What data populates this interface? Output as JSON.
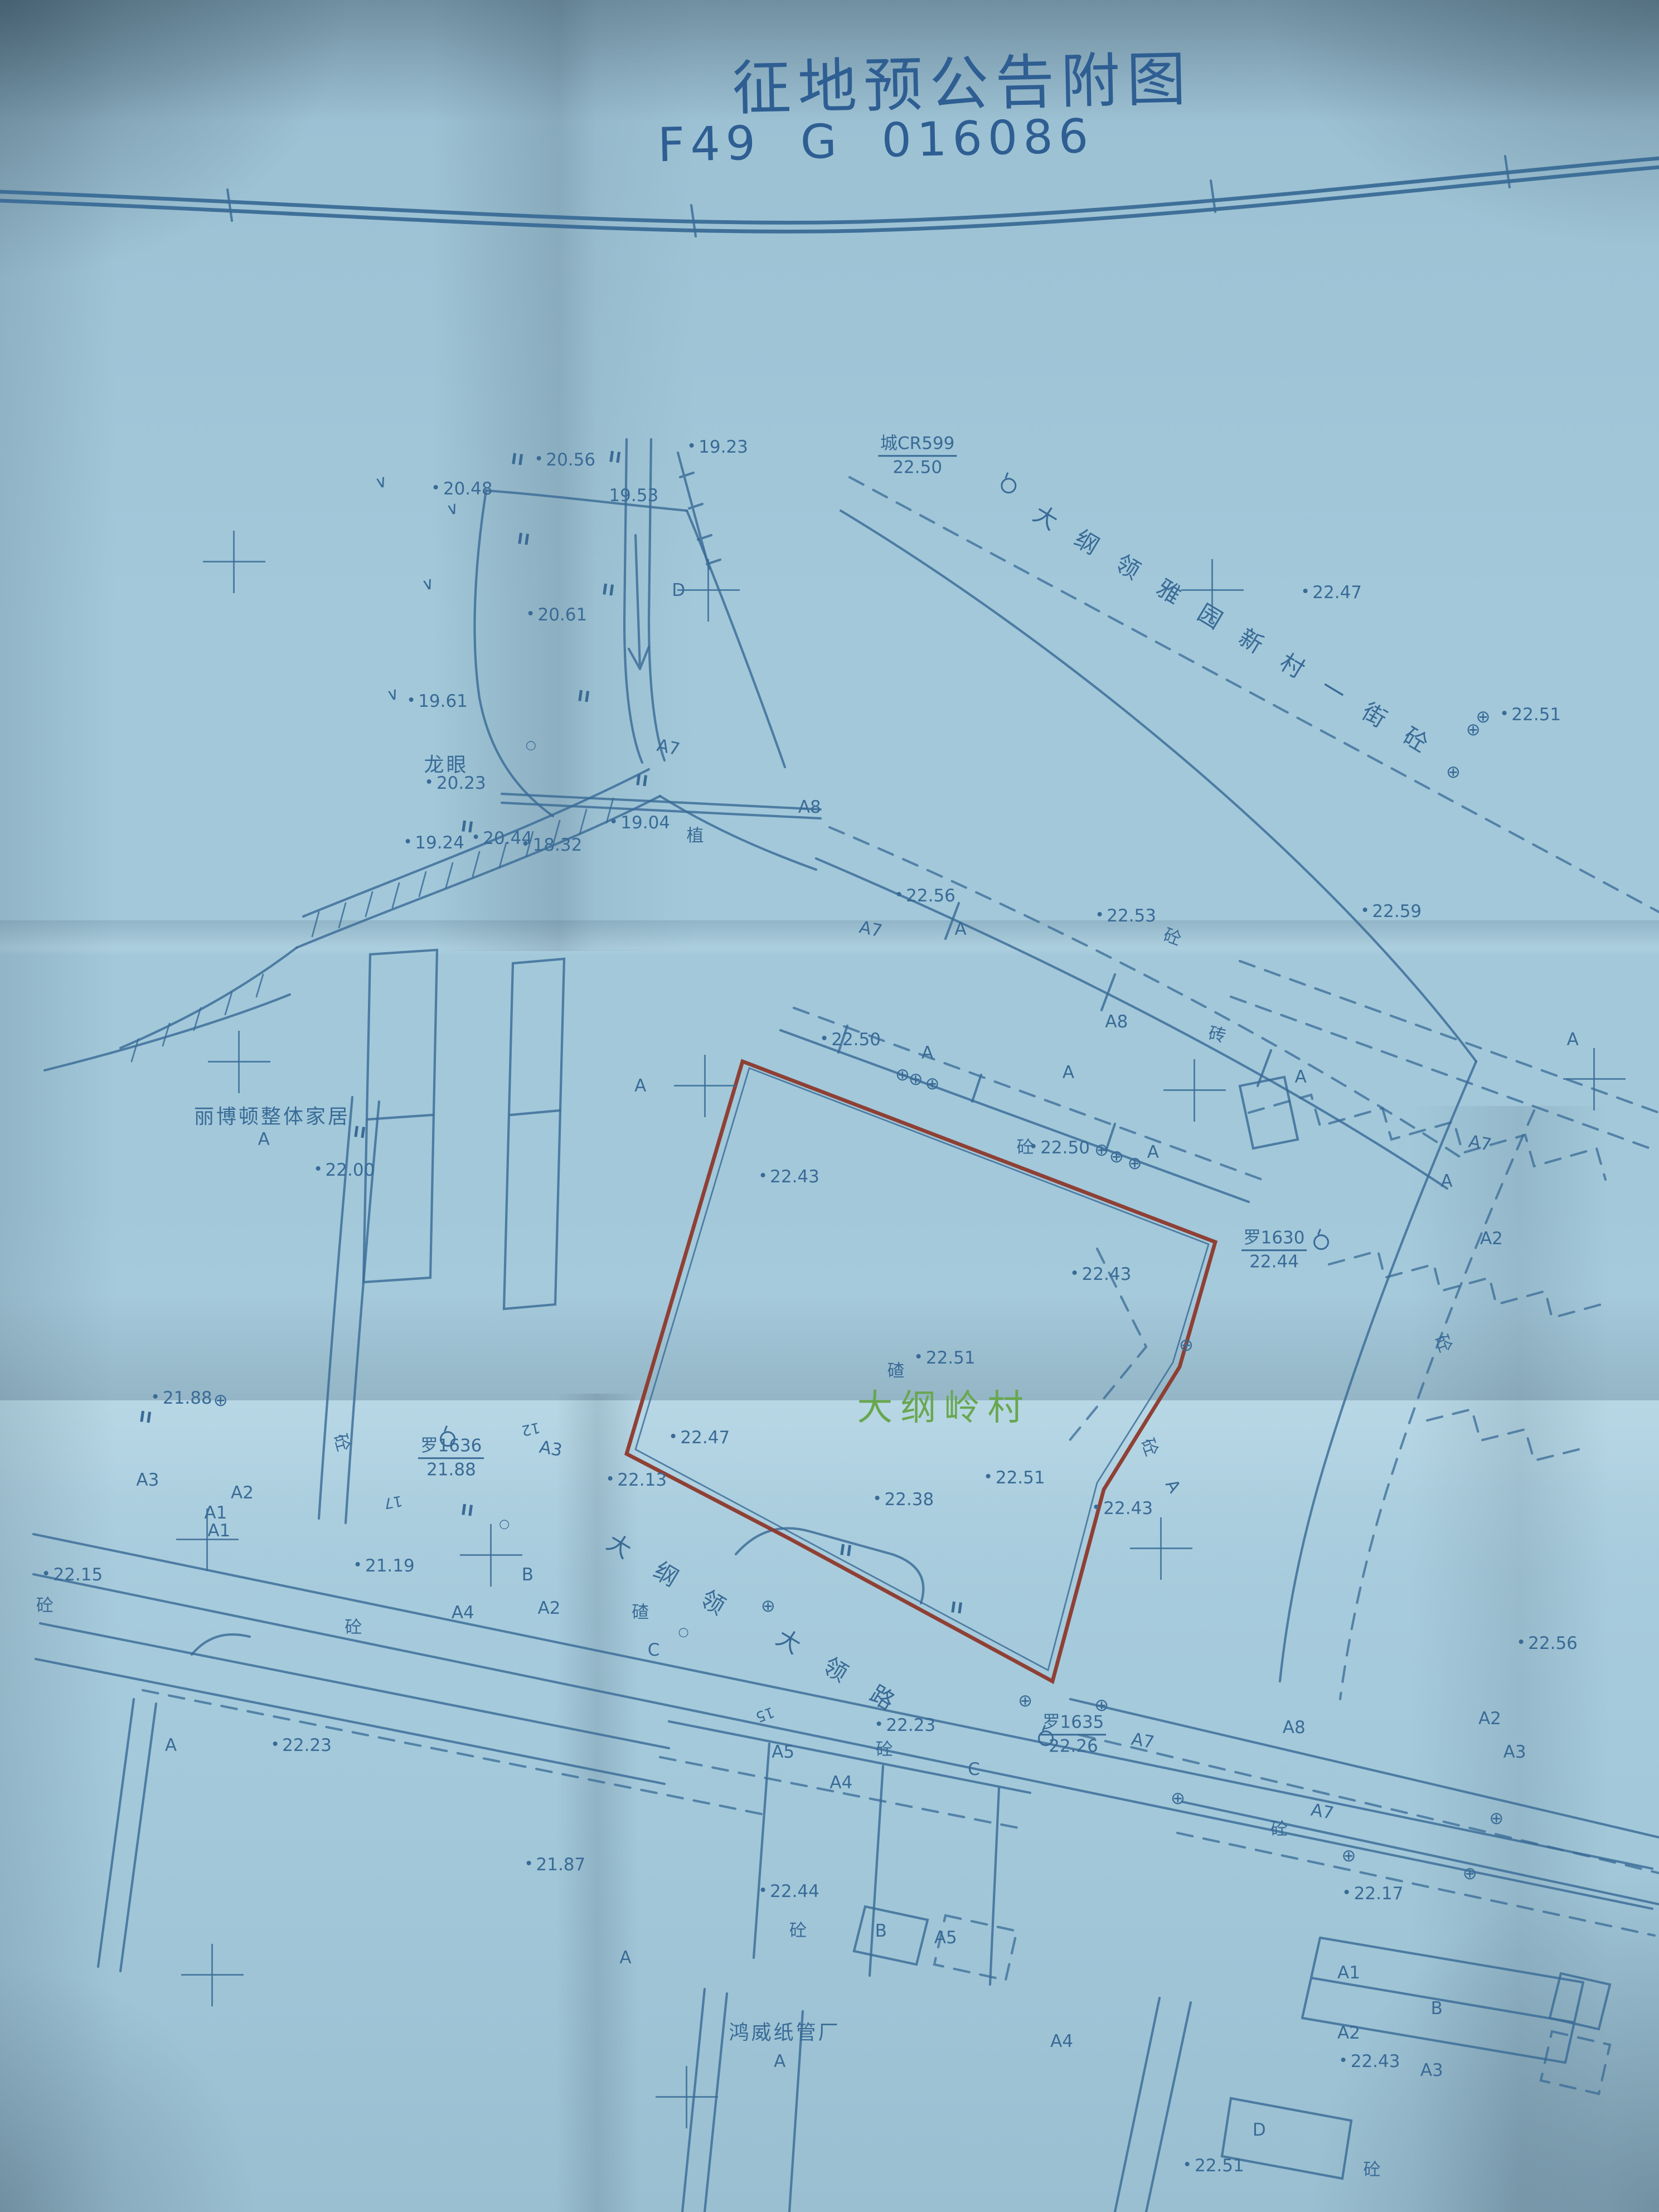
{
  "title": {
    "line1": "征地预公告附图",
    "line2": "F49 G 016086"
  },
  "colors": {
    "paper": "#a2c8da",
    "ink": "#3a6b96",
    "red_boundary": "#8e3a2e",
    "village_green": "#69a750",
    "title_blue": "#2e5e92"
  },
  "roads": {
    "road1": {
      "name": "大纲领雅园新村一街砼"
    },
    "road2_part1": "大纲领",
    "road2_part2": "大领路"
  },
  "icons": {
    "lamp": "⊕",
    "circle": "○",
    "veg": "∨",
    "paddy": "II"
  },
  "control_points": [
    {
      "name": "城CR599",
      "elev": "22.50",
      "x": 55.3,
      "y": 20.6,
      "sx": 150,
      "sy": 40
    },
    {
      "name": "罗1630",
      "elev": "22.44",
      "x": 76.8,
      "y": 56.5,
      "sx": 70,
      "sy": -28
    },
    {
      "name": "罗1636",
      "elev": "21.88",
      "x": 27.2,
      "y": 65.9,
      "sx": -20,
      "sy": -48
    },
    {
      "name": "罗1635",
      "elev": "22.26",
      "x": 64.7,
      "y": 78.4,
      "sx": -63,
      "sy": -7
    }
  ],
  "labels": [
    {
      "t": "20.56",
      "x": 34.4,
      "y": 20.8,
      "c": "elev"
    },
    {
      "t": "19.23",
      "x": 43.6,
      "y": 20.2,
      "c": "elev"
    },
    {
      "t": "20.48",
      "x": 28.2,
      "y": 22.1,
      "c": "elev"
    },
    {
      "t": "19.53",
      "x": 38.2,
      "y": 22.4,
      "c": "plain"
    },
    {
      "t": "20.61",
      "x": 33.9,
      "y": 27.8,
      "c": "elev"
    },
    {
      "t": "D",
      "x": 40.9,
      "y": 26.7,
      "c": "bld"
    },
    {
      "t": "19.61",
      "x": 26.7,
      "y": 31.7,
      "c": "elev"
    },
    {
      "t": "龙眼",
      "x": 26.9,
      "y": 34.5,
      "c": "name"
    },
    {
      "t": "20.23",
      "x": 27.8,
      "y": 35.4,
      "c": "elev"
    },
    {
      "t": "A7",
      "x": 40.3,
      "y": 33.8,
      "c": "bld",
      "r": 12
    },
    {
      "t": "19.24",
      "x": 26.5,
      "y": 38.1,
      "c": "elev"
    },
    {
      "t": "20.44",
      "x": 30.6,
      "y": 37.9,
      "c": "elev"
    },
    {
      "t": "18.32",
      "x": 33.6,
      "y": 38.2,
      "c": "elev"
    },
    {
      "t": "19.04",
      "x": 38.9,
      "y": 37.2,
      "c": "elev"
    },
    {
      "t": "植",
      "x": 41.9,
      "y": 37.7,
      "c": "mat"
    },
    {
      "t": "A8",
      "x": 48.8,
      "y": 36.5,
      "c": "bld"
    },
    {
      "t": "22.47",
      "x": 80.6,
      "y": 26.8,
      "c": "elev"
    },
    {
      "t": "22.51",
      "x": 92.6,
      "y": 32.3,
      "c": "elev"
    },
    {
      "t": "A7",
      "x": 52.5,
      "y": 42.0,
      "c": "bld",
      "r": 12
    },
    {
      "t": "22.56",
      "x": 56.1,
      "y": 40.5,
      "c": "elev"
    },
    {
      "t": "A",
      "x": 57.9,
      "y": 42.0,
      "c": "bld"
    },
    {
      "t": "22.53",
      "x": 68.2,
      "y": 41.4,
      "c": "elev"
    },
    {
      "t": "砼",
      "x": 70.7,
      "y": 42.3,
      "c": "mat",
      "r": 20
    },
    {
      "t": "22.59",
      "x": 84.2,
      "y": 41.2,
      "c": "elev"
    },
    {
      "t": "A8",
      "x": 67.3,
      "y": 46.2,
      "c": "bld"
    },
    {
      "t": "砖",
      "x": 73.4,
      "y": 46.7,
      "c": "mat",
      "r": 12
    },
    {
      "t": "A",
      "x": 78.4,
      "y": 48.7,
      "c": "bld"
    },
    {
      "t": "A",
      "x": 94.8,
      "y": 47.0,
      "c": "bld"
    },
    {
      "t": "A7",
      "x": 89.2,
      "y": 51.7,
      "c": "bld",
      "r": 10
    },
    {
      "t": "A",
      "x": 87.2,
      "y": 53.4,
      "c": "bld"
    },
    {
      "t": "22.50",
      "x": 51.6,
      "y": 47.0,
      "c": "elev"
    },
    {
      "t": "A",
      "x": 55.9,
      "y": 47.6,
      "c": "bld"
    },
    {
      "t": "A",
      "x": 64.4,
      "y": 48.5,
      "c": "bld"
    },
    {
      "t": "A",
      "x": 69.5,
      "y": 52.1,
      "c": "bld"
    },
    {
      "t": "A",
      "x": 38.6,
      "y": 49.1,
      "c": "bld"
    },
    {
      "t": "22.43",
      "x": 47.9,
      "y": 53.2,
      "c": "elev"
    },
    {
      "t": "砼",
      "x": 61.8,
      "y": 51.8,
      "c": "mat"
    },
    {
      "t": "22.50",
      "x": 64.2,
      "y": 51.9,
      "c": "elev"
    },
    {
      "t": "22.43",
      "x": 66.7,
      "y": 57.6,
      "c": "elev"
    },
    {
      "t": "A2",
      "x": 89.9,
      "y": 56.0,
      "c": "bld"
    },
    {
      "t": "砼",
      "x": 87.1,
      "y": 60.7,
      "c": "mat",
      "r": 70
    },
    {
      "t": "碴",
      "x": 54.0,
      "y": 61.9,
      "c": "mat"
    },
    {
      "t": "22.51",
      "x": 57.3,
      "y": 61.4,
      "c": "elev"
    },
    {
      "t": "大纲岭村",
      "x": 56.9,
      "y": 63.5,
      "c": "village"
    },
    {
      "t": "22.00",
      "x": 21.1,
      "y": 52.9,
      "c": "elev"
    },
    {
      "t": "丽博顿整体家居",
      "x": 16.4,
      "y": 50.4,
      "c": "name"
    },
    {
      "t": "A",
      "x": 15.9,
      "y": 51.5,
      "c": "bld"
    },
    {
      "t": "22.47",
      "x": 42.5,
      "y": 65.0,
      "c": "elev"
    },
    {
      "t": "22.13",
      "x": 38.7,
      "y": 66.9,
      "c": "elev"
    },
    {
      "t": "21.88",
      "x": 11.3,
      "y": 63.2,
      "c": "elev"
    },
    {
      "t": "砼",
      "x": 20.7,
      "y": 65.2,
      "c": "mat",
      "r": 75
    },
    {
      "t": "A3",
      "x": 33.2,
      "y": 65.5,
      "c": "bld",
      "r": 10
    },
    {
      "t": "12",
      "x": 32.0,
      "y": 64.6,
      "c": "small",
      "r": 168
    },
    {
      "t": "A3",
      "x": 8.9,
      "y": 66.9,
      "c": "bld"
    },
    {
      "t": "A2",
      "x": 14.6,
      "y": 67.5,
      "c": "bld"
    },
    {
      "t": "A1",
      "x": 13.0,
      "y": 68.4,
      "c": "bld"
    },
    {
      "t": "A1",
      "x": 13.2,
      "y": 69.2,
      "c": "bld"
    },
    {
      "t": "17",
      "x": 23.7,
      "y": 67.9,
      "c": "small",
      "r": 170
    },
    {
      "t": "22.51",
      "x": 61.5,
      "y": 66.8,
      "c": "elev"
    },
    {
      "t": "22.38",
      "x": 54.8,
      "y": 67.8,
      "c": "elev"
    },
    {
      "t": "22.43",
      "x": 68.0,
      "y": 68.2,
      "c": "elev"
    },
    {
      "t": "砼",
      "x": 69.4,
      "y": 65.4,
      "c": "mat",
      "r": 70
    },
    {
      "t": "A",
      "x": 70.7,
      "y": 67.2,
      "c": "bld",
      "r": 60
    },
    {
      "t": "22.15",
      "x": 4.7,
      "y": 71.2,
      "c": "elev"
    },
    {
      "t": "砼",
      "x": 2.7,
      "y": 72.5,
      "c": "mat"
    },
    {
      "t": "21.19",
      "x": 23.5,
      "y": 70.8,
      "c": "elev"
    },
    {
      "t": "B",
      "x": 31.8,
      "y": 71.2,
      "c": "bld"
    },
    {
      "t": "砼",
      "x": 21.3,
      "y": 73.5,
      "c": "mat"
    },
    {
      "t": "A4",
      "x": 27.9,
      "y": 72.9,
      "c": "bld"
    },
    {
      "t": "A2",
      "x": 33.1,
      "y": 72.7,
      "c": "bld"
    },
    {
      "t": "碴",
      "x": 38.6,
      "y": 72.8,
      "c": "mat"
    },
    {
      "t": "C",
      "x": 39.4,
      "y": 74.6,
      "c": "bld"
    },
    {
      "t": "15",
      "x": 46.1,
      "y": 77.5,
      "c": "small",
      "r": 160
    },
    {
      "t": "22.23",
      "x": 54.9,
      "y": 78.0,
      "c": "elev"
    },
    {
      "t": "砼",
      "x": 53.3,
      "y": 79.0,
      "c": "mat"
    },
    {
      "t": "22.23",
      "x": 18.5,
      "y": 78.9,
      "c": "elev"
    },
    {
      "t": "A",
      "x": 10.3,
      "y": 78.9,
      "c": "bld"
    },
    {
      "t": "21.87",
      "x": 33.8,
      "y": 84.3,
      "c": "elev"
    },
    {
      "t": "A",
      "x": 37.7,
      "y": 88.5,
      "c": "bld"
    },
    {
      "t": "A5",
      "x": 47.2,
      "y": 79.2,
      "c": "bld"
    },
    {
      "t": "A4",
      "x": 50.7,
      "y": 80.6,
      "c": "bld"
    },
    {
      "t": "C",
      "x": 58.7,
      "y": 80.0,
      "c": "bld"
    },
    {
      "t": "22.44",
      "x": 47.9,
      "y": 85.5,
      "c": "elev"
    },
    {
      "t": "砼",
      "x": 48.1,
      "y": 87.2,
      "c": "mat"
    },
    {
      "t": "B",
      "x": 53.1,
      "y": 87.3,
      "c": "bld"
    },
    {
      "t": "A5",
      "x": 57.0,
      "y": 87.6,
      "c": "bld"
    },
    {
      "t": "A7",
      "x": 68.9,
      "y": 78.7,
      "c": "bld",
      "r": 10
    },
    {
      "t": "A8",
      "x": 78.0,
      "y": 78.1,
      "c": "bld"
    },
    {
      "t": "A7",
      "x": 79.7,
      "y": 81.9,
      "c": "bld",
      "r": 10
    },
    {
      "t": "A2",
      "x": 89.8,
      "y": 77.7,
      "c": "bld"
    },
    {
      "t": "A3",
      "x": 91.3,
      "y": 79.2,
      "c": "bld"
    },
    {
      "t": "22.56",
      "x": 93.6,
      "y": 74.3,
      "c": "elev"
    },
    {
      "t": "砼",
      "x": 77.1,
      "y": 82.6,
      "c": "mat"
    },
    {
      "t": "22.17",
      "x": 83.1,
      "y": 85.6,
      "c": "elev"
    },
    {
      "t": "A1",
      "x": 81.3,
      "y": 89.2,
      "c": "bld"
    },
    {
      "t": "A2",
      "x": 81.3,
      "y": 91.9,
      "c": "bld"
    },
    {
      "t": "B",
      "x": 86.6,
      "y": 90.8,
      "c": "bld"
    },
    {
      "t": "A3",
      "x": 86.3,
      "y": 93.6,
      "c": "bld"
    },
    {
      "t": "22.43",
      "x": 82.9,
      "y": 93.2,
      "c": "elev"
    },
    {
      "t": "D",
      "x": 75.9,
      "y": 96.3,
      "c": "bld"
    },
    {
      "t": "砼",
      "x": 82.7,
      "y": 98.0,
      "c": "mat"
    },
    {
      "t": "22.51",
      "x": 73.5,
      "y": 97.9,
      "c": "elev"
    },
    {
      "t": "A4",
      "x": 64.0,
      "y": 92.3,
      "c": "bld"
    },
    {
      "t": "鸿威纸管厂",
      "x": 47.3,
      "y": 91.8,
      "c": "name"
    },
    {
      "t": "A",
      "x": 47.0,
      "y": 93.2,
      "c": "bld"
    },
    {
      "t": "II",
      "x": 31.2,
      "y": 20.8,
      "c": "ii",
      "r": 8
    },
    {
      "t": "II",
      "x": 37.1,
      "y": 20.7,
      "c": "ii",
      "r": 8
    },
    {
      "t": "II",
      "x": 31.6,
      "y": 24.4,
      "c": "ii",
      "r": 8
    },
    {
      "t": "II",
      "x": 36.7,
      "y": 26.7,
      "c": "ii",
      "r": 8
    },
    {
      "t": "II",
      "x": 35.2,
      "y": 31.5,
      "c": "ii",
      "r": 8
    },
    {
      "t": "II",
      "x": 38.7,
      "y": 35.3,
      "c": "ii",
      "r": 8
    },
    {
      "t": "II",
      "x": 28.2,
      "y": 37.4,
      "c": "ii",
      "r": 8
    },
    {
      "t": "II",
      "x": 21.7,
      "y": 51.2,
      "c": "ii",
      "r": 8
    },
    {
      "t": "II",
      "x": 8.8,
      "y": 64.1,
      "c": "ii",
      "r": 8
    },
    {
      "t": "II",
      "x": 28.2,
      "y": 68.3,
      "c": "ii",
      "r": 8
    },
    {
      "t": "II",
      "x": 51.0,
      "y": 70.1,
      "c": "ii",
      "r": 8
    },
    {
      "t": "II",
      "x": 57.7,
      "y": 72.7,
      "c": "ii",
      "r": 8
    },
    {
      "t": "∨",
      "x": 27.3,
      "y": 23.0,
      "c": "sym",
      "r": -15
    },
    {
      "t": "∨",
      "x": 25.8,
      "y": 26.4,
      "c": "sym",
      "r": -15
    },
    {
      "t": "∨",
      "x": 23.7,
      "y": 31.4,
      "c": "sym",
      "r": -15
    },
    {
      "t": "∨",
      "x": 23.0,
      "y": 21.8,
      "c": "sym",
      "r": -15
    },
    {
      "t": "○",
      "x": 32.0,
      "y": 33.7,
      "c": "osym"
    },
    {
      "t": "○",
      "x": 41.2,
      "y": 73.8,
      "c": "osym"
    },
    {
      "t": "○",
      "x": 30.4,
      "y": 68.9,
      "c": "osym"
    }
  ],
  "lamps": [
    [
      54.4,
      48.6
    ],
    [
      55.2,
      48.8
    ],
    [
      56.2,
      49.0
    ],
    [
      66.4,
      52.0
    ],
    [
      67.3,
      52.3
    ],
    [
      68.4,
      52.6
    ],
    [
      88.8,
      33.0
    ],
    [
      89.4,
      32.4
    ],
    [
      87.6,
      34.9
    ],
    [
      71.5,
      60.8
    ],
    [
      13.3,
      63.3
    ],
    [
      46.3,
      72.6
    ],
    [
      61.8,
      76.9
    ],
    [
      66.4,
      77.1
    ],
    [
      71.0,
      81.3
    ],
    [
      81.3,
      83.9
    ],
    [
      88.6,
      84.7
    ],
    [
      90.2,
      82.2
    ]
  ],
  "crosses": [
    [
      14.1,
      25.4
    ],
    [
      42.7,
      26.7
    ],
    [
      73.1,
      26.7
    ],
    [
      14.4,
      48.0
    ],
    [
      42.5,
      49.1
    ],
    [
      72.0,
      49.3
    ],
    [
      96.1,
      48.8
    ],
    [
      12.5,
      69.6
    ],
    [
      29.6,
      70.3
    ],
    [
      70.0,
      70.0
    ],
    [
      12.8,
      89.3
    ],
    [
      41.4,
      94.8
    ]
  ]
}
